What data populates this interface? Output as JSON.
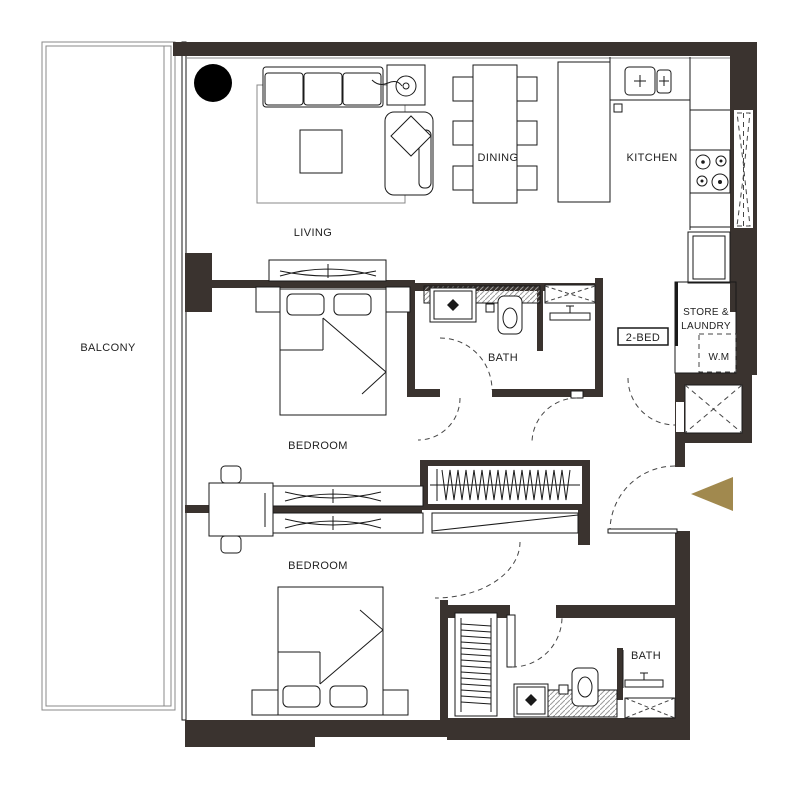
{
  "plan": {
    "title": "2-bedroom apartment floor plan",
    "unit_badge": "2-BED",
    "labels": {
      "balcony": "BALCONY",
      "living": "LIVING",
      "dining": "DINING",
      "kitchen": "KITCHEN",
      "store_line1": "STORE &",
      "store_line2": "LAUNDRY",
      "wm": "W.M",
      "bath_top": "BATH",
      "bath_bottom": "BATH",
      "bedroom_top": "BEDROOM",
      "bedroom_bottom": "BEDROOM"
    },
    "colors": {
      "wall": "#3a332f",
      "entry_arrow": "#a1894e",
      "line": "#1a1a1a",
      "background": "#ffffff"
    },
    "symbols": [
      "sofa",
      "armchair",
      "floor-lamp",
      "coffee-table",
      "rug",
      "tv-console",
      "dining-table",
      "dining-chair",
      "kitchen-island",
      "kitchen-sink",
      "cooktop",
      "tall-cabinet",
      "washing-machine",
      "duct-shaft",
      "shower-tray",
      "shower-head",
      "toilet",
      "wash-basin",
      "wardrobe-hangers",
      "closet",
      "double-bed",
      "pillow",
      "bedside-table",
      "dressing-table",
      "stool",
      "door-swing",
      "entry-arrow"
    ]
  }
}
